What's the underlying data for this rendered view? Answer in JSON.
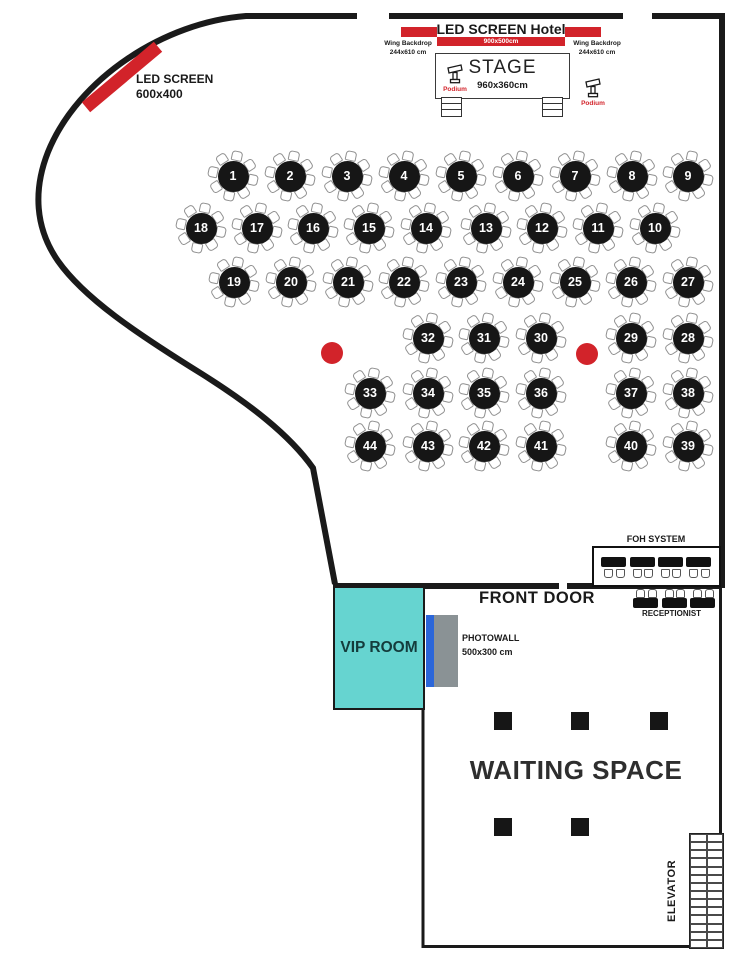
{
  "colors": {
    "red": "#d2232a",
    "teal": "#66d4d0",
    "blue": "#2b66d9",
    "gray": "#8a9295",
    "wall": "#1a1a1a"
  },
  "stage": {
    "title": "LED SCREEN Hotel",
    "screen_size": "900x500cm",
    "stage_label": "STAGE",
    "stage_size": "960x360cm",
    "wing_left_line1": "Wing Backdrop",
    "wing_left_line2": "244x610 cm",
    "wing_right_line1": "Wing Backdrop",
    "wing_right_line2": "244x610 cm",
    "podium_left": "Podium",
    "podium_right": "Podium"
  },
  "side_led": {
    "line1": "LED SCREEN",
    "line2": "600x400"
  },
  "labels": {
    "front_door": "FRONT DOOR",
    "foh": "FOH SYSTEM",
    "receptionist": "RECEPTIONIST",
    "vip": "VIP ROOM",
    "photowall_line1": "PHOTOWALL",
    "photowall_line2": "500x300 cm",
    "waiting": "WAITING SPACE",
    "elevator": "ELEVATOR"
  },
  "floor": {
    "tables": [
      {
        "n": "1",
        "x": 233,
        "y": 176
      },
      {
        "n": "2",
        "x": 290,
        "y": 176
      },
      {
        "n": "3",
        "x": 347,
        "y": 176
      },
      {
        "n": "4",
        "x": 404,
        "y": 176
      },
      {
        "n": "5",
        "x": 461,
        "y": 176
      },
      {
        "n": "6",
        "x": 518,
        "y": 176
      },
      {
        "n": "7",
        "x": 575,
        "y": 176
      },
      {
        "n": "8",
        "x": 632,
        "y": 176
      },
      {
        "n": "9",
        "x": 688,
        "y": 176
      },
      {
        "n": "18",
        "x": 201,
        "y": 228
      },
      {
        "n": "17",
        "x": 257,
        "y": 228
      },
      {
        "n": "16",
        "x": 313,
        "y": 228
      },
      {
        "n": "15",
        "x": 369,
        "y": 228
      },
      {
        "n": "14",
        "x": 426,
        "y": 228
      },
      {
        "n": "13",
        "x": 486,
        "y": 228
      },
      {
        "n": "12",
        "x": 542,
        "y": 228
      },
      {
        "n": "11",
        "x": 598,
        "y": 228
      },
      {
        "n": "10",
        "x": 655,
        "y": 228
      },
      {
        "n": "19",
        "x": 234,
        "y": 282
      },
      {
        "n": "20",
        "x": 291,
        "y": 282
      },
      {
        "n": "21",
        "x": 348,
        "y": 282
      },
      {
        "n": "22",
        "x": 404,
        "y": 282
      },
      {
        "n": "23",
        "x": 461,
        "y": 282
      },
      {
        "n": "24",
        "x": 518,
        "y": 282
      },
      {
        "n": "25",
        "x": 575,
        "y": 282
      },
      {
        "n": "26",
        "x": 631,
        "y": 282
      },
      {
        "n": "27",
        "x": 688,
        "y": 282
      },
      {
        "n": "32",
        "x": 428,
        "y": 338
      },
      {
        "n": "31",
        "x": 484,
        "y": 338
      },
      {
        "n": "30",
        "x": 541,
        "y": 338
      },
      {
        "n": "29",
        "x": 631,
        "y": 338
      },
      {
        "n": "28",
        "x": 688,
        "y": 338
      },
      {
        "n": "33",
        "x": 370,
        "y": 393
      },
      {
        "n": "34",
        "x": 428,
        "y": 393
      },
      {
        "n": "35",
        "x": 484,
        "y": 393
      },
      {
        "n": "36",
        "x": 541,
        "y": 393
      },
      {
        "n": "37",
        "x": 631,
        "y": 393
      },
      {
        "n": "38",
        "x": 688,
        "y": 393
      },
      {
        "n": "44",
        "x": 370,
        "y": 446
      },
      {
        "n": "43",
        "x": 428,
        "y": 446
      },
      {
        "n": "42",
        "x": 484,
        "y": 446
      },
      {
        "n": "41",
        "x": 541,
        "y": 446
      },
      {
        "n": "40",
        "x": 631,
        "y": 446
      },
      {
        "n": "39",
        "x": 688,
        "y": 446
      }
    ],
    "dots": [
      {
        "x": 332,
        "y": 353
      },
      {
        "x": 587,
        "y": 354
      }
    ],
    "pillars": [
      {
        "x": 494,
        "y": 712
      },
      {
        "x": 571,
        "y": 712
      },
      {
        "x": 650,
        "y": 712
      },
      {
        "x": 494,
        "y": 818
      },
      {
        "x": 571,
        "y": 818
      }
    ],
    "foh_tables_x": [
      601,
      629.5,
      657.5,
      686
    ],
    "foh_tables_y": 557,
    "reception_tables_x": [
      633,
      661.5,
      690
    ],
    "reception_tables_y": 598,
    "elevator_rows": 14,
    "elevator_cols": 2
  }
}
